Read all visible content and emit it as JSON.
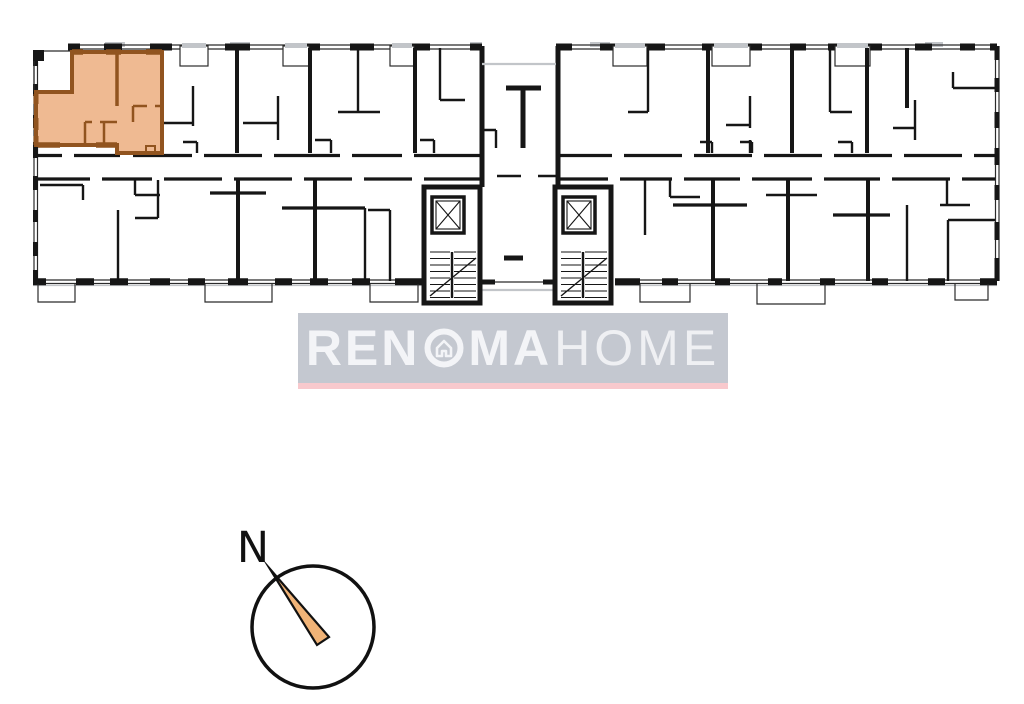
{
  "page": {
    "background_color": "#ffffff"
  },
  "colors": {
    "page-bg": "#ffffff",
    "plan-line": "#161616",
    "plan-thin": "#2b2b2b",
    "plan-gray": "#c2c5c9",
    "highlight-fill": "#efba92",
    "highlight-stroke": "#91541f",
    "wm-bg": "rgba(186,190,200,0.85)",
    "wm-underline": "#f8c9cd",
    "wm-text": "#f3f4f7",
    "needle-fill": "#f0b377",
    "compass-line": "#111111"
  },
  "floor_plan": {
    "type": "residential-building-storey-plan",
    "highlighted_unit": {
      "position": "top-left",
      "fill_color": "#efba92",
      "outline_color": "#91541f"
    }
  },
  "watermark": {
    "brand_part1": "REN",
    "brand_part2": "MA",
    "brand_part3": "HOME",
    "icon": "house-in-circle"
  },
  "compass": {
    "north_label": "N"
  }
}
